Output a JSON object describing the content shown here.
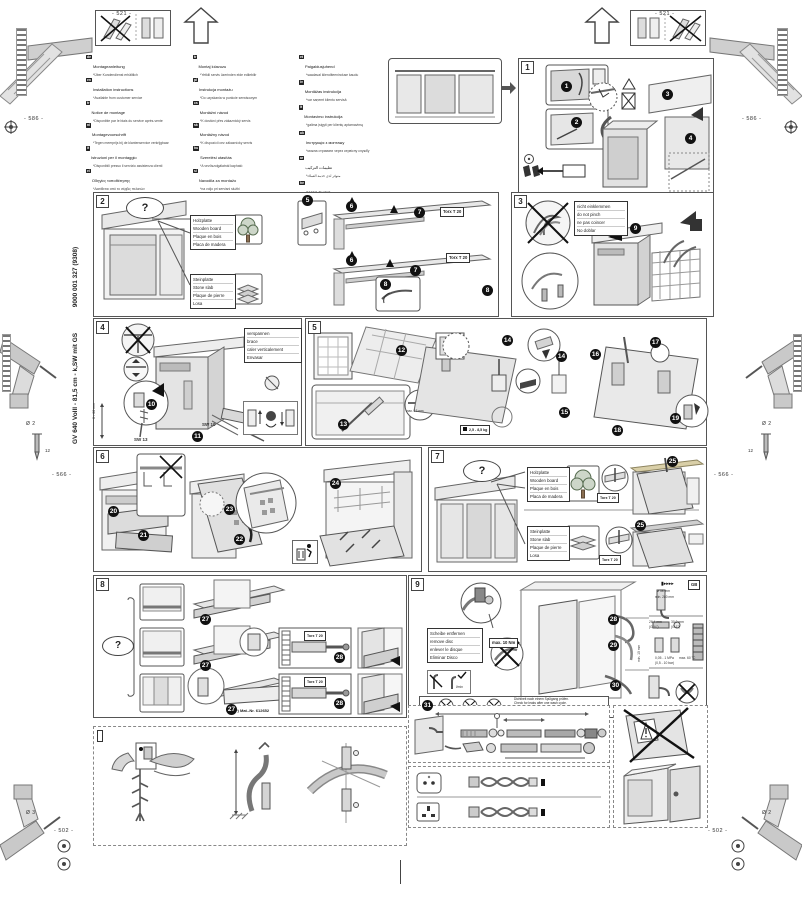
{
  "page": {
    "doc_code_vertical": "GV 640 VollI - 81,5 cm - k,SW mit GS",
    "doc_number_vertical": "9000 001 327 (9308)",
    "dims": {
      "d521": "- 521 -",
      "d586": "- 586 -",
      "d566": "- 566 -",
      "d502": "- 502 -",
      "d12": "12",
      "dia2": "Ø 2",
      "dia3": "Ø 3"
    }
  },
  "languages": {
    "col1": [
      {
        "code": "de",
        "l1": "Montageanleitung",
        "l2": "*Über Kundendienst erhältlich"
      },
      {
        "code": "en",
        "l1": "Installation instructions",
        "l2": "*Available from customer service"
      },
      {
        "code": "fr",
        "l1": "Notice de montage",
        "l2": "*Disponible par le biais du service après-vente"
      },
      {
        "code": "nl",
        "l1": "Montagevoorschrift",
        "l2": "*Tegen meerprijs bij de klantenservice verkrijgbaar"
      },
      {
        "code": "it",
        "l1": "Istruzioni per il montaggio",
        "l2": "*Disponibili presso il servizio assistenza clienti"
      },
      {
        "code": "el",
        "l1": "Οδηγίες τοποθέτησης",
        "l2": "*Διατίθεται από το σέρβις πελατών"
      },
      {
        "code": "es",
        "l1": "Instrucciones de montaje",
        "l2": "*) Se puede adquirir a través del Servicio de Asistencia Técnica"
      },
      {
        "code": "pt",
        "l1": "Instruções de montagem",
        "l2": "*Pode ser adquirido nos nossos Serviços Técnicos"
      },
      {
        "code": "sv",
        "l1": "Monteringsanvisning",
        "l2": "*finns hos Service"
      },
      {
        "code": "no",
        "l1": "Monteringsanvisning",
        "l2": "*fåes hos kundeservice"
      },
      {
        "code": "fi",
        "l1": "Asennusohje",
        "l2": "*saatavana huoltopalvelusta"
      },
      {
        "code": "da",
        "l1": "Monteringsvejledning",
        "l2": "*Kan købes hos serviceafdelingen"
      }
    ],
    "col2": [
      {
        "code": "tr",
        "l1": "Montaj kılavuzu",
        "l2": "*Yetkili servis üzerinden elde edilebilir"
      },
      {
        "code": "pl",
        "l1": "Instrukcja montażu",
        "l2": "*Do uzyskania w punkcie serwisowym"
      },
      {
        "code": "cs",
        "l1": "Montážní návod",
        "l2": "*K dostání přes zákaznický servis"
      },
      {
        "code": "sk",
        "l1": "Montážny návod",
        "l2": "*K dispozícii cez zákaznícky servis"
      },
      {
        "code": "hu",
        "l1": "Szerelési utasítás",
        "l2": "*A vevőszolgálatnál kapható"
      },
      {
        "code": "sl",
        "l1": "Navodila za montažo",
        "l2": "*na voljo pri servisni službi"
      },
      {
        "code": "hr",
        "l1": "Uputa za montažu",
        "l2": "*može se dobiti preko servisne službe"
      },
      {
        "code": "sr",
        "l1": "Uputstvo za montažu",
        "l2": "*može se nabaviti preko servisne službe"
      },
      {
        "code": "ro",
        "l1": "Instrucţiuni de montaj",
        "l2": "*se pot obţine de la service"
      },
      {
        "code": "bg",
        "l1": "Указания за монтаж",
        "l2": "*получава се чрез сервиза"
      },
      {
        "code": "mk",
        "l1": "Упатство за монтажа",
        "l2": "*се добива преку сервисната служба"
      },
      {
        "code": "ru",
        "l1": "Инструкция по монтажу",
        "l2": "*можно получить через сервисную службу"
      }
    ],
    "col3": [
      {
        "code": "et",
        "l1": "Paigaldusjuhend",
        "l2": "*saadaval klienditeeninduse kaudu"
      },
      {
        "code": "lv",
        "l1": "Montāžas instrukcija",
        "l2": "*var saņemt klientu servisā"
      },
      {
        "code": "lt",
        "l1": "Montavimo instrukcija",
        "l2": "*galima įsigyti per klientų aptarnavimą"
      },
      {
        "code": "uk",
        "l1": "Інструкція з монтажу",
        "l2": "*можна отримати через сервісну службу"
      },
      {
        "code": "ar",
        "l1": "تعليمات التركيب",
        "l2": "*متوفر لدى خدمة العملاء"
      },
      {
        "code": "he",
        "l1": "הוראות הרכבה",
        "l2": "*ניתן להשיג בשירות הלקוחות"
      },
      {
        "code": "zh",
        "l1": "安装说明",
        "l2": "*可向客户服务部门索取"
      },
      {
        "code": "ko",
        "l1": "설치 설명서",
        "l2": "*고객 서비스 센터에서 구입 가능"
      },
      {
        "code": "kk",
        "l1": "Монтаждау нұсқаулығы",
        "l2": "*сервис қызметі арқылы алуға болады"
      }
    ]
  },
  "steps": {
    "n1": "1",
    "n2": "2",
    "n3": "3",
    "n4": "4",
    "n5": "5",
    "n6": "6",
    "n7": "7",
    "n8": "8",
    "n9": "9",
    "n10": "10",
    "n11": "11",
    "n12": "12",
    "n13": "13",
    "n14": "14",
    "n15": "15",
    "n16": "16",
    "n17": "17",
    "n18": "18",
    "n19": "19",
    "n20": "20",
    "n21": "21",
    "n22": "22",
    "n23": "23",
    "n24": "24",
    "n25": "25",
    "n26": "26",
    "n27": "27",
    "n28": "28",
    "n29": "29",
    "n30": "30",
    "n31": "31"
  },
  "panels": {
    "p1": {
      "num": "1"
    },
    "p2": {
      "num": "2",
      "q": "?",
      "wood": {
        "a": "Holzplatte",
        "b": "Wooden board",
        "c": "Plaque en bois",
        "d": "Placa de madera"
      },
      "stone": {
        "a": "Steinplatte",
        "b": "Stone slab",
        "c": "Plaque de pierre",
        "d": "Losa"
      },
      "torx": "Torx T 20"
    },
    "p3": {
      "num": "3",
      "note": {
        "a": "nicht einklemmen",
        "b": "do not pinch",
        "c": "ne pas coincer",
        "d": "No doblar"
      }
    },
    "p4": {
      "num": "4",
      "note": {
        "a": "verspannen",
        "b": "brace",
        "c": "caler verticalement",
        "d": "Envasar"
      },
      "sw13": "SW 13",
      "sw10": "SW 10",
      "range": "0 - 60 mm"
    },
    "p5": {
      "num": "5",
      "max13": "max. 13 mm",
      "weight": "2,5 - 8,5 kg"
    },
    "p6": {
      "num": "6"
    },
    "p7": {
      "num": "7",
      "q": "?",
      "wood": {
        "a": "Holzplatte",
        "b": "Wooden board",
        "c": "Plaque en bois",
        "d": "Placa de madera"
      },
      "stone": {
        "a": "Steinplatte",
        "b": "Stone slab",
        "c": "Plaque de pierre",
        "d": "Losa"
      },
      "torx": "Torx T 20"
    },
    "p8": {
      "num": "8",
      "q": "?",
      "torx": "Torx T 20",
      "mat": "*) Mat.-Nr. 612652"
    },
    "p9": {
      "num": "9",
      "q": "",
      "note": {
        "a": "Scheibe entfernen",
        "b": "remove disc",
        "c": "enlever le disque",
        "d": "Eliminar Disco"
      },
      "max_nm": "max. 10 Nm",
      "gb_ref": "GB",
      "lmin": "l/min",
      "check": {
        "a": "Dichtheit nach einem Spülgang prüfen.",
        "b": "Check for leaks after one wash cycle.",
        "c": "Vérifier l'étanchéité après un lavage.",
        "d": "Verificar la estanqueidad tras un ciclo de lavado."
      },
      "specs": {
        "a38": "ø 38 mm",
        "min280": "min. 280 mm",
        "t1": "26,4 mm",
        "t1b": "(G ¾\")",
        "t2": "30,0 mm",
        "t2b": "(G 1\")",
        "press": "0,05 - 1 MPa",
        "press2": "(0,5 - 10 bar)",
        "temp": "max. 60 °C",
        "min10": "min. 10 mm"
      }
    },
    "gb": {
      "label": "GB",
      "max11": "max. 1,1 m"
    },
    "hose": {
      "max4": "max. 4 m",
      "m2": "2 m",
      "m22": "2,2 m",
      "mat": "*) Mat.-Nr. 350564"
    },
    "cords": {
      "m3a": "3 m",
      "m3b": "3 m",
      "eu": "EU",
      "gb": "GB",
      "mat_eu": "*) Mat.-Nr. 644533",
      "mat_gb": "*) Mat.-Nr. 644534"
    }
  }
}
